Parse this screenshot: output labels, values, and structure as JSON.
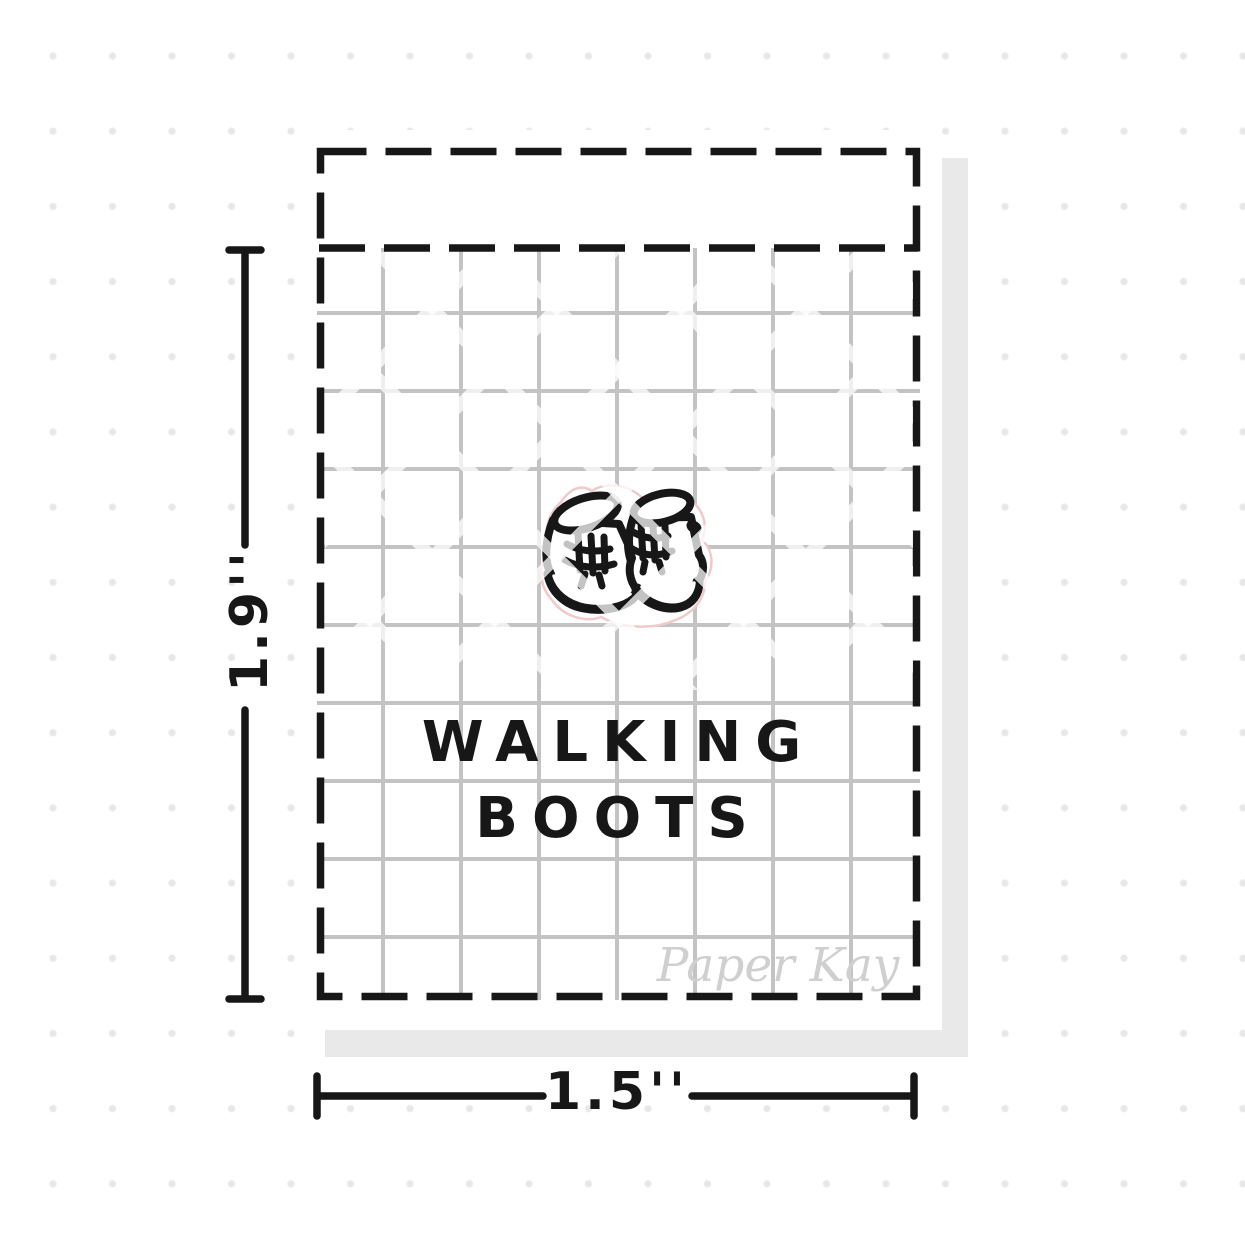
{
  "sticker": {
    "title_line1": "WALKING",
    "title_line2": "BOOTS",
    "icon": "walking-boots-icon",
    "brand_watermark": "Paper Kay"
  },
  "dimensions": {
    "height_label": "1.9''",
    "width_label": "1.5''"
  },
  "colors": {
    "ink_black": "#171717",
    "journal_grid_line": "#c3c3c3",
    "background_dot": "#e7e7e7",
    "sheet_shadow": "#e9e9e9",
    "diecut_pink": "#f0caca",
    "brand_script_gray": "#cfcfcf",
    "watermark_stripe_gray": "#bcbcbc"
  }
}
